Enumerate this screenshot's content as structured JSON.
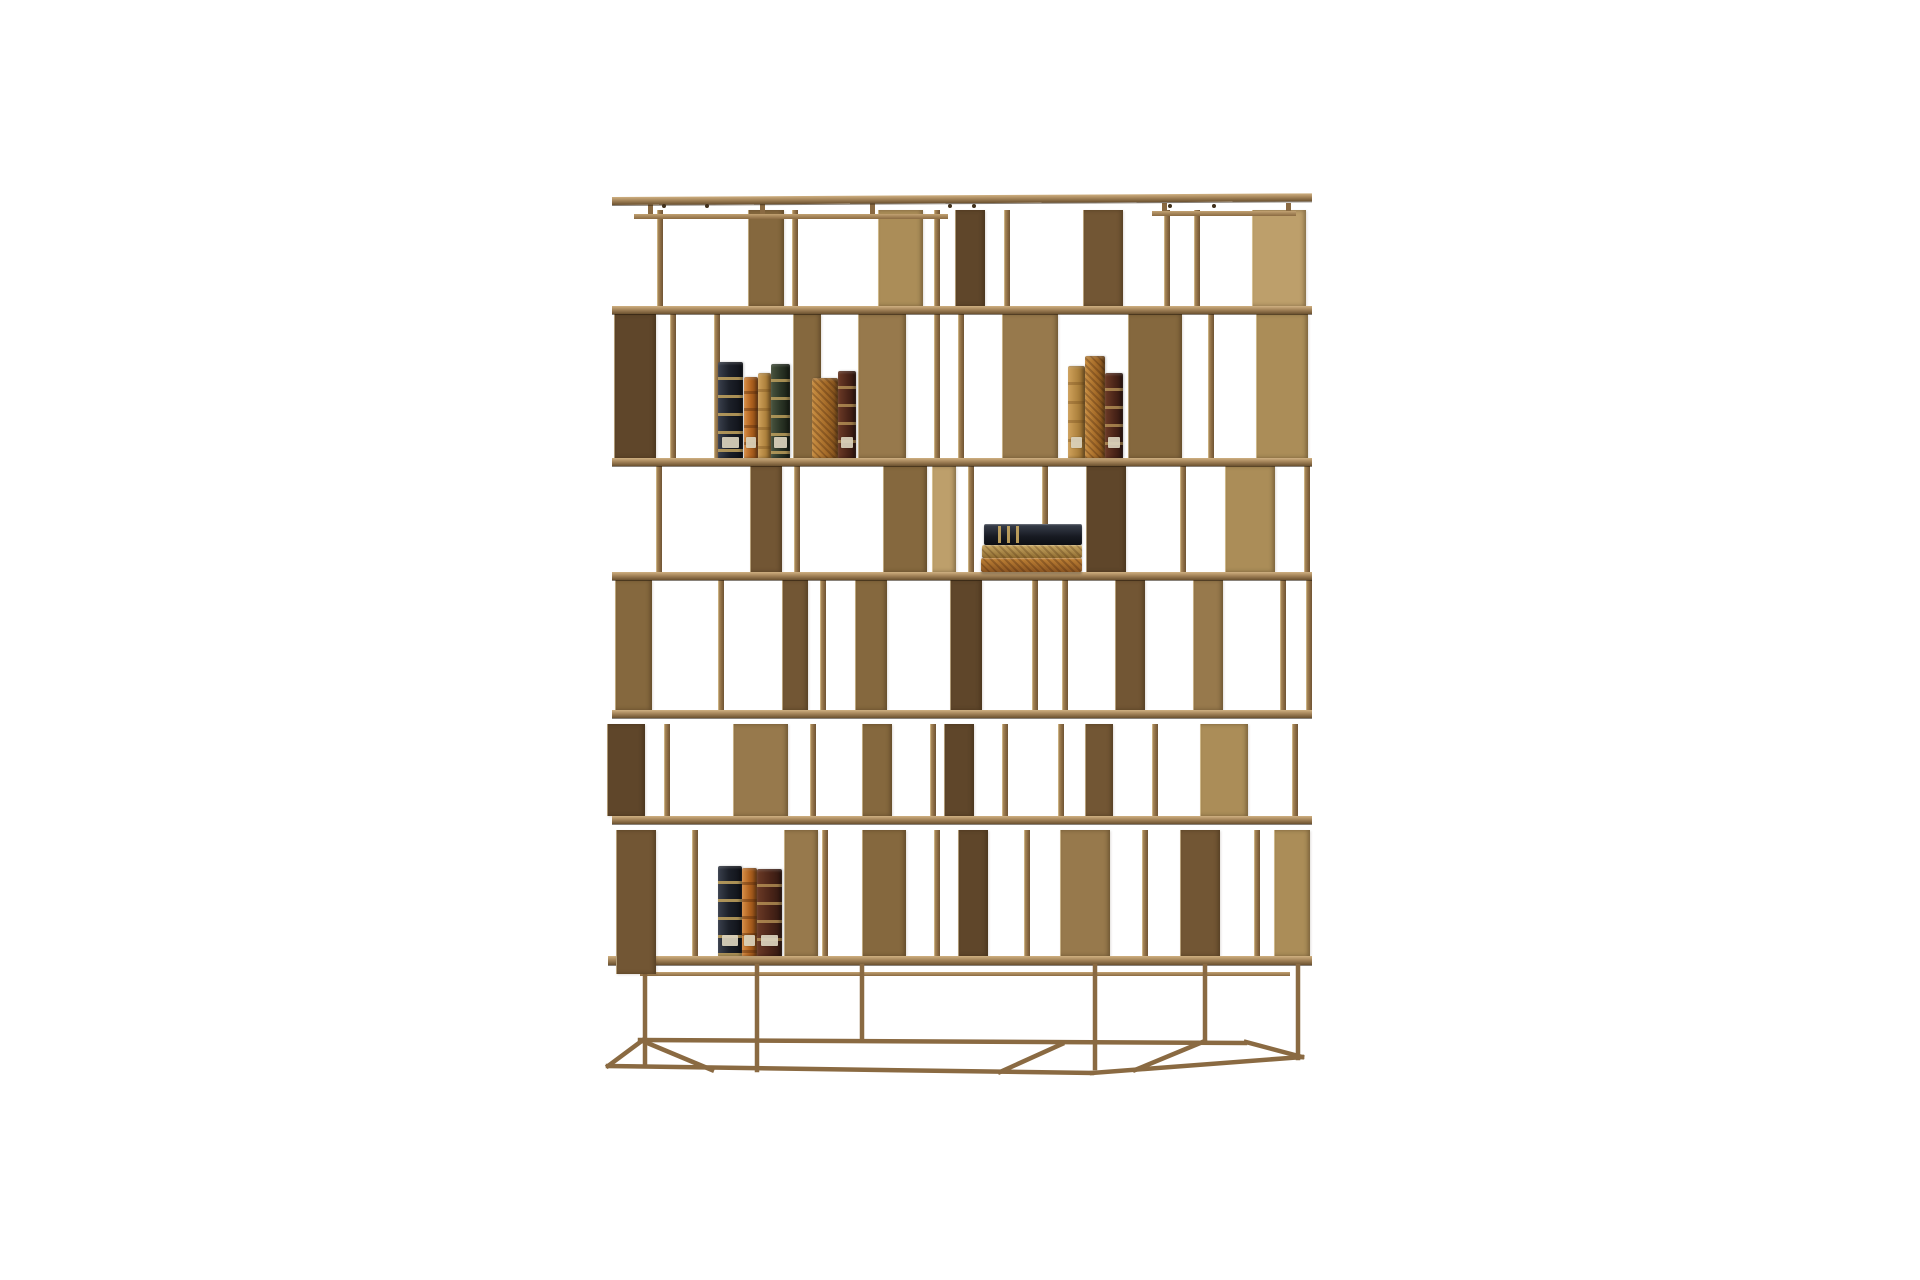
{
  "scene": {
    "description": "Product photograph of a burnished-brass modular bookcase with staggered open compartments holding a few antique leather-bound books, on a plain white background",
    "background": "#ffffff",
    "canvas": {
      "w": 1920,
      "h": 1280
    },
    "palette": {
      "bronze_light": "#cbad7a",
      "bronze_mid": "#9e7f50",
      "bronze_dark": "#5c4428",
      "bronze_deep": "#47321c",
      "shelf_top": "#cfb081",
      "edge_highlight": "#f2e0b8",
      "book_navy": "#1c2029",
      "book_orange": "#b0621f",
      "book_tan": "#b0843f",
      "book_green": "#2b3526",
      "book_maroon": "#4a2418",
      "book_marbled": "#a56b28",
      "label_cream": "#dbd3bd",
      "gold_bands": "#c4a45e"
    },
    "cap": {
      "y": 197,
      "x1": 612,
      "x2": 1312,
      "h": 8,
      "tilt": -0.3,
      "stubs": [
        648,
        760,
        870,
        1162,
        1286
      ],
      "screws": [
        662,
        705,
        948,
        972,
        1168,
        1212
      ]
    },
    "subrails": [
      {
        "y": 214,
        "x1": 634,
        "x2": 948,
        "h": 5
      },
      {
        "y": 211,
        "x1": 1152,
        "x2": 1296,
        "h": 5
      },
      {
        "y": 972,
        "x1": 640,
        "x2": 1290,
        "h": 4
      }
    ],
    "shelves": [
      {
        "y": 306,
        "x1": 612,
        "x2": 1312,
        "h": 8
      },
      {
        "y": 458,
        "x1": 612,
        "x2": 1312,
        "h": 8
      },
      {
        "y": 572,
        "x1": 612,
        "x2": 1312,
        "h": 8
      },
      {
        "y": 710,
        "x1": 612,
        "x2": 1312,
        "h": 8
      },
      {
        "y": 816,
        "x1": 612,
        "x2": 1312,
        "h": 8
      },
      {
        "y": 956,
        "x1": 608,
        "x2": 1312,
        "h": 9
      }
    ],
    "bands": [
      {
        "name": "band-1",
        "y1": 210,
        "y2": 306,
        "elements": [
          {
            "x": 657,
            "t": "post"
          },
          {
            "x": 748,
            "w": 36,
            "tone": "mid-dark"
          },
          {
            "x": 792,
            "t": "post"
          },
          {
            "x": 878,
            "w": 45,
            "tone": "light-mid"
          },
          {
            "x": 934,
            "t": "post"
          },
          {
            "x": 955,
            "w": 30,
            "tone": "dark"
          },
          {
            "x": 1004,
            "t": "post"
          },
          {
            "x": 1083,
            "w": 40,
            "tone": "dark-mid"
          },
          {
            "x": 1164,
            "t": "post"
          },
          {
            "x": 1194,
            "t": "post"
          },
          {
            "x": 1252,
            "w": 54,
            "tone": "light"
          }
        ]
      },
      {
        "name": "band-2",
        "y1": 314,
        "y2": 458,
        "elements": [
          {
            "x": 614,
            "w": 42,
            "tone": "dark"
          },
          {
            "x": 670,
            "t": "post"
          },
          {
            "x": 714,
            "t": "post"
          },
          {
            "x": 793,
            "w": 28,
            "tone": "mid-dark"
          },
          {
            "x": 858,
            "w": 48,
            "tone": "mid"
          },
          {
            "x": 934,
            "t": "post"
          },
          {
            "x": 958,
            "t": "post"
          },
          {
            "x": 1002,
            "w": 56,
            "tone": "mid"
          },
          {
            "x": 1128,
            "w": 54,
            "tone": "mid-dark"
          },
          {
            "x": 1208,
            "t": "post"
          },
          {
            "x": 1256,
            "w": 52,
            "tone": "light-mid"
          }
        ]
      },
      {
        "name": "band-3",
        "y1": 466,
        "y2": 572,
        "elements": [
          {
            "x": 656,
            "t": "post"
          },
          {
            "x": 750,
            "w": 32,
            "tone": "dark-mid"
          },
          {
            "x": 794,
            "t": "post"
          },
          {
            "x": 883,
            "w": 44,
            "tone": "mid-dark"
          },
          {
            "x": 932,
            "w": 24,
            "tone": "light"
          },
          {
            "x": 968,
            "t": "post"
          },
          {
            "x": 1042,
            "t": "post"
          },
          {
            "x": 1086,
            "w": 40,
            "tone": "dark"
          },
          {
            "x": 1180,
            "t": "post"
          },
          {
            "x": 1225,
            "w": 50,
            "tone": "light-mid"
          },
          {
            "x": 1304,
            "t": "post"
          }
        ]
      },
      {
        "name": "band-4",
        "y1": 580,
        "y2": 710,
        "elements": [
          {
            "x": 615,
            "w": 37,
            "tone": "mid-dark"
          },
          {
            "x": 718,
            "t": "post"
          },
          {
            "x": 782,
            "w": 26,
            "tone": "dark-mid"
          },
          {
            "x": 820,
            "t": "post"
          },
          {
            "x": 855,
            "w": 32,
            "tone": "mid-dark"
          },
          {
            "x": 950,
            "w": 32,
            "tone": "dark"
          },
          {
            "x": 1032,
            "t": "post"
          },
          {
            "x": 1062,
            "t": "post"
          },
          {
            "x": 1115,
            "w": 30,
            "tone": "dark-mid"
          },
          {
            "x": 1193,
            "w": 30,
            "tone": "mid"
          },
          {
            "x": 1280,
            "t": "post"
          },
          {
            "x": 1306,
            "t": "post"
          }
        ]
      },
      {
        "name": "band-5",
        "y1": 724,
        "y2": 816,
        "elements": [
          {
            "x": 607,
            "w": 38,
            "tone": "dark"
          },
          {
            "x": 664,
            "t": "post"
          },
          {
            "x": 733,
            "w": 55,
            "tone": "mid"
          },
          {
            "x": 810,
            "t": "post"
          },
          {
            "x": 862,
            "w": 30,
            "tone": "mid-dark"
          },
          {
            "x": 930,
            "t": "post"
          },
          {
            "x": 944,
            "w": 30,
            "tone": "dark"
          },
          {
            "x": 1002,
            "t": "post"
          },
          {
            "x": 1058,
            "t": "post"
          },
          {
            "x": 1085,
            "w": 28,
            "tone": "dark-mid"
          },
          {
            "x": 1152,
            "t": "post"
          },
          {
            "x": 1200,
            "w": 48,
            "tone": "light-mid"
          },
          {
            "x": 1292,
            "t": "post"
          }
        ]
      },
      {
        "name": "band-6",
        "y1": 830,
        "y2": 956,
        "elements": [
          {
            "x": 616,
            "w": 40,
            "tone": "dark-mid",
            "y2": 974,
            "front": true
          },
          {
            "x": 692,
            "t": "post"
          },
          {
            "x": 784,
            "w": 34,
            "tone": "mid"
          },
          {
            "x": 822,
            "t": "post"
          },
          {
            "x": 862,
            "w": 44,
            "tone": "mid-dark"
          },
          {
            "x": 934,
            "t": "post"
          },
          {
            "x": 958,
            "w": 30,
            "tone": "dark"
          },
          {
            "x": 1024,
            "t": "post"
          },
          {
            "x": 1060,
            "w": 50,
            "tone": "mid"
          },
          {
            "x": 1142,
            "t": "post"
          },
          {
            "x": 1180,
            "w": 40,
            "tone": "dark-mid"
          },
          {
            "x": 1254,
            "t": "post"
          },
          {
            "x": 1274,
            "w": 36,
            "tone": "light-mid"
          }
        ]
      }
    ],
    "books": {
      "groups": [
        {
          "name": "upper-left-books",
          "kind": "standing",
          "baseline": 458,
          "items": [
            {
              "x": 718,
              "w": 25,
              "top": 362,
              "style": "navy",
              "label": true
            },
            {
              "x": 744,
              "w": 14,
              "top": 377,
              "style": "orange",
              "label": true
            },
            {
              "x": 758,
              "w": 13,
              "top": 373,
              "style": "tan",
              "label": false
            },
            {
              "x": 771,
              "w": 19,
              "top": 364,
              "style": "green",
              "label": true
            },
            {
              "x": 812,
              "w": 26,
              "top": 378,
              "style": "marbled",
              "label": false
            },
            {
              "x": 838,
              "w": 18,
              "top": 371,
              "style": "maroon",
              "label": true
            }
          ]
        },
        {
          "name": "upper-right-books",
          "kind": "standing",
          "baseline": 458,
          "items": [
            {
              "x": 1068,
              "w": 17,
              "top": 366,
              "style": "tan",
              "label": true
            },
            {
              "x": 1085,
              "w": 20,
              "top": 356,
              "style": "marbled",
              "label": false
            },
            {
              "x": 1105,
              "w": 18,
              "top": 373,
              "style": "maroon",
              "label": true
            }
          ]
        },
        {
          "name": "stacked-flat-books",
          "kind": "flat",
          "items": [
            {
              "x": 984,
              "w": 98,
              "y": 524,
              "h": 21,
              "style": "navy",
              "ribs": true
            },
            {
              "x": 982,
              "w": 100,
              "y": 545,
              "h": 13,
              "style": "marbled-tan",
              "ribs": false
            },
            {
              "x": 981,
              "w": 101,
              "y": 558,
              "h": 14,
              "style": "marbled",
              "ribs": false
            }
          ]
        },
        {
          "name": "lower-left-books",
          "kind": "standing",
          "baseline": 956,
          "items": [
            {
              "x": 718,
              "w": 24,
              "top": 866,
              "style": "navy",
              "label": true
            },
            {
              "x": 742,
              "w": 15,
              "top": 868,
              "style": "orange",
              "label": true
            },
            {
              "x": 757,
              "w": 25,
              "top": 869,
              "style": "maroon",
              "label": true
            }
          ]
        }
      ]
    },
    "base": {
      "stroke": "#8a6a42",
      "stroke_width": 4.5,
      "lines": [
        [
          645,
          966,
          645,
          1066
        ],
        [
          757,
          966,
          757,
          1070
        ],
        [
          862,
          966,
          862,
          1040
        ],
        [
          1095,
          966,
          1095,
          1068
        ],
        [
          1205,
          966,
          1205,
          1040
        ],
        [
          1298,
          966,
          1298,
          1058
        ],
        [
          640,
          1040,
          1245,
          1043
        ],
        [
          608,
          1066,
          1092,
          1073
        ],
        [
          1092,
          1073,
          1302,
          1057
        ],
        [
          608,
          1066,
          643,
          1040
        ],
        [
          1302,
          1057,
          1246,
          1042
        ],
        [
          645,
          1042,
          712,
          1070
        ],
        [
          1205,
          1041,
          1135,
          1070
        ],
        [
          1000,
          1072,
          1062,
          1044
        ]
      ]
    }
  }
}
